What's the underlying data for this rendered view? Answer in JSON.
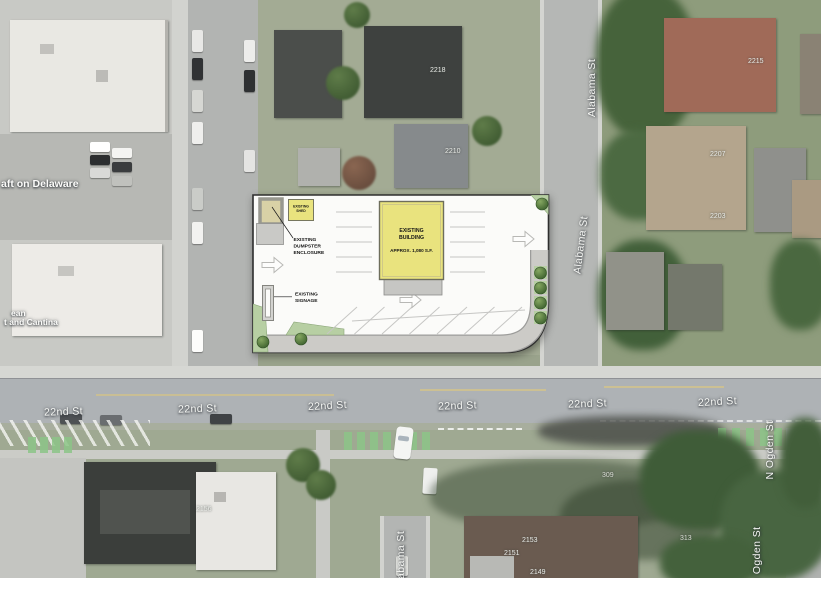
{
  "plan": {
    "building": {
      "line1": "EXISTING",
      "line2": "BUILDING",
      "area": "APPROX. 1,080 S.F."
    },
    "shed": {
      "line1": "EXISTING",
      "line2": "SHED"
    },
    "dumpster": {
      "line1": "EXISTING",
      "line2": "DUMPSTER",
      "line3": "ENCLOSURE"
    },
    "signage": {
      "line1": "EXISTING",
      "line2": "SIGNAGE"
    }
  },
  "streets": {
    "s22nd": "22nd St",
    "alabama": "Alabama St",
    "n_ogden": "N Ogden St"
  },
  "pois": {
    "delaware": "aft on Delaware",
    "cantina_line1": "ean",
    "cantina_line2": "t and Cantina"
  },
  "house_numbers": [
    "2218",
    "2210",
    "2215",
    "2207",
    "2203",
    "309",
    "313",
    "2156",
    "2153",
    "2151",
    "2149"
  ],
  "colors": {
    "plan_yellow": "#e9e37e",
    "landscape_green": "#b7cfa3",
    "tree_green": "#4f7a3a",
    "bike_lane_green": "#8cc487",
    "concrete_gray": "#c9c9c6",
    "plan_background": "#fbfbf9"
  }
}
